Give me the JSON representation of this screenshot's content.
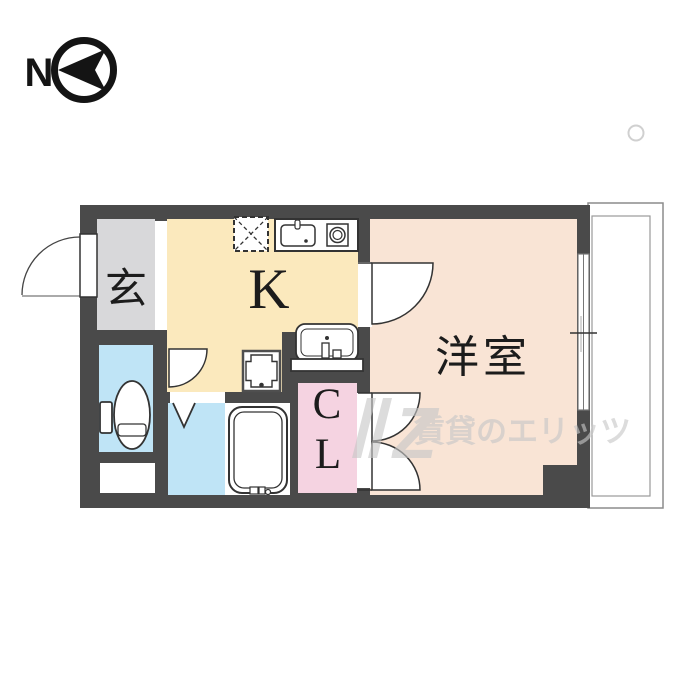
{
  "compass": {
    "label": "N"
  },
  "rooms": {
    "entrance": {
      "label": "玄"
    },
    "kitchen": {
      "label": "K"
    },
    "western_room": {
      "label": "洋室"
    },
    "closet": {
      "line1": "C",
      "line2": "L"
    }
  },
  "watermark": {
    "brand_text": "賃貸のエリッツ",
    "logo_letter": "Z"
  },
  "colors": {
    "wall": "#4a4a4a",
    "entrance_floor": "#d8d8da",
    "kitchen_floor": "#fbe9bd",
    "western_floor": "#f9e4d5",
    "closet_floor": "#f5d3e1",
    "water_floor": "#bfe4f6",
    "label_ink": "#1c1c1c",
    "watermark_gray": "#c7c7c7"
  }
}
